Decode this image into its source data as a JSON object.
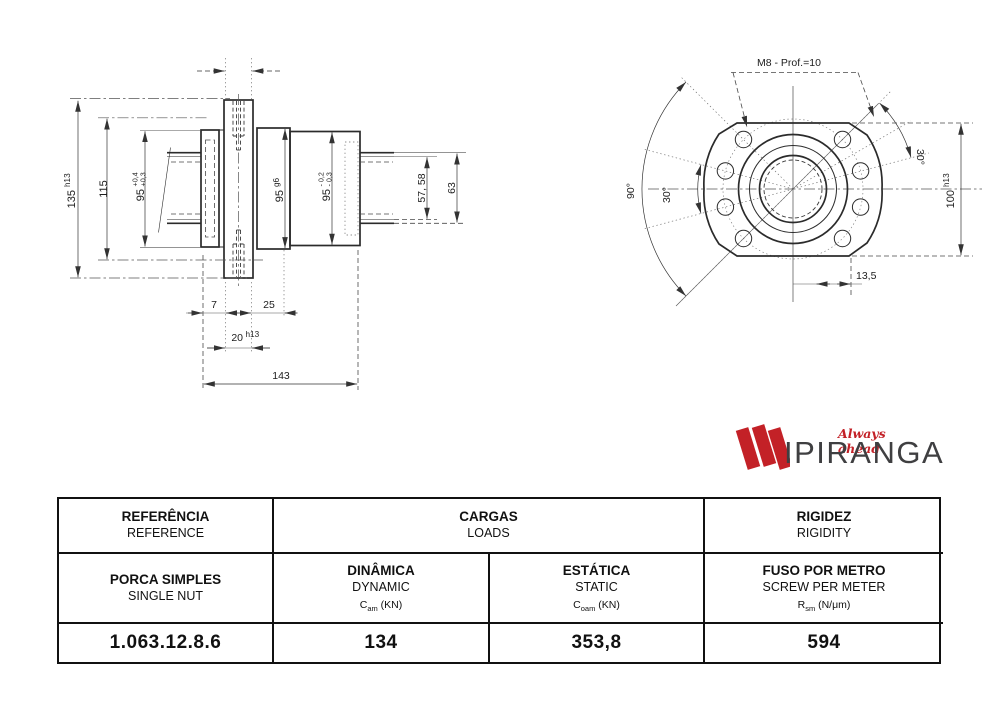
{
  "drawing": {
    "side_view": {
      "dim_135": "135",
      "dim_135_tol": "h13",
      "dim_115": "115",
      "dim_95_flange": "95",
      "dim_95_flange_tol_upper": "+0,4",
      "dim_95_flange_tol_lower": "+0,3",
      "dim_95_body": "95",
      "dim_95_body_tol": "g6",
      "dim_95_end": "95",
      "dim_95_end_tol_upper": "- 0,2",
      "dim_95_end_tol_lower": "- 0,3",
      "dim_57_58": "57, 58",
      "dim_63": "63",
      "dim_7": "7",
      "dim_25": "25",
      "dim_20": "20",
      "dim_20_tol": "h13",
      "dim_143": "143"
    },
    "front_view": {
      "thread_note": "M8 - Prof.=10",
      "angle_90": "90°",
      "angle_30_left": "30°",
      "angle_30_right": "30°",
      "dim_100": "100",
      "dim_100_tol": "h13",
      "dim_13_5": "13,5"
    }
  },
  "logo": {
    "brand": "IPIRANGA",
    "tagline": "Always ahead",
    "accent_color": "#c32127",
    "brand_color": "#3f3f41"
  },
  "table": {
    "header": {
      "reference_pt": "REFERÊNCIA",
      "reference_en": "REFERENCE",
      "loads_pt": "CARGAS",
      "loads_en": "LOADS",
      "rigidity_pt": "RIGIDEZ",
      "rigidity_en": "RIGIDITY"
    },
    "subheader": {
      "product_pt": "PORCA SIMPLES",
      "product_en": "SINGLE NUT",
      "dynamic_pt": "DINÂMICA",
      "dynamic_en": "DYNAMIC",
      "dynamic_sym": "C",
      "dynamic_sub": "am",
      "dynamic_unit": " (KN)",
      "static_pt": "ESTÁTICA",
      "static_en": "STATIC",
      "static_sym": "C",
      "static_sub": "oam",
      "static_unit": " (KN)",
      "screw_pt": "FUSO POR METRO",
      "screw_en": "SCREW PER METER",
      "screw_sym": "R",
      "screw_sub": "sm",
      "screw_unit": " (N/μm)"
    },
    "values": {
      "reference": "1.063.12.8.6",
      "dynamic": "134",
      "static": "353,8",
      "rigidity": "594"
    }
  }
}
